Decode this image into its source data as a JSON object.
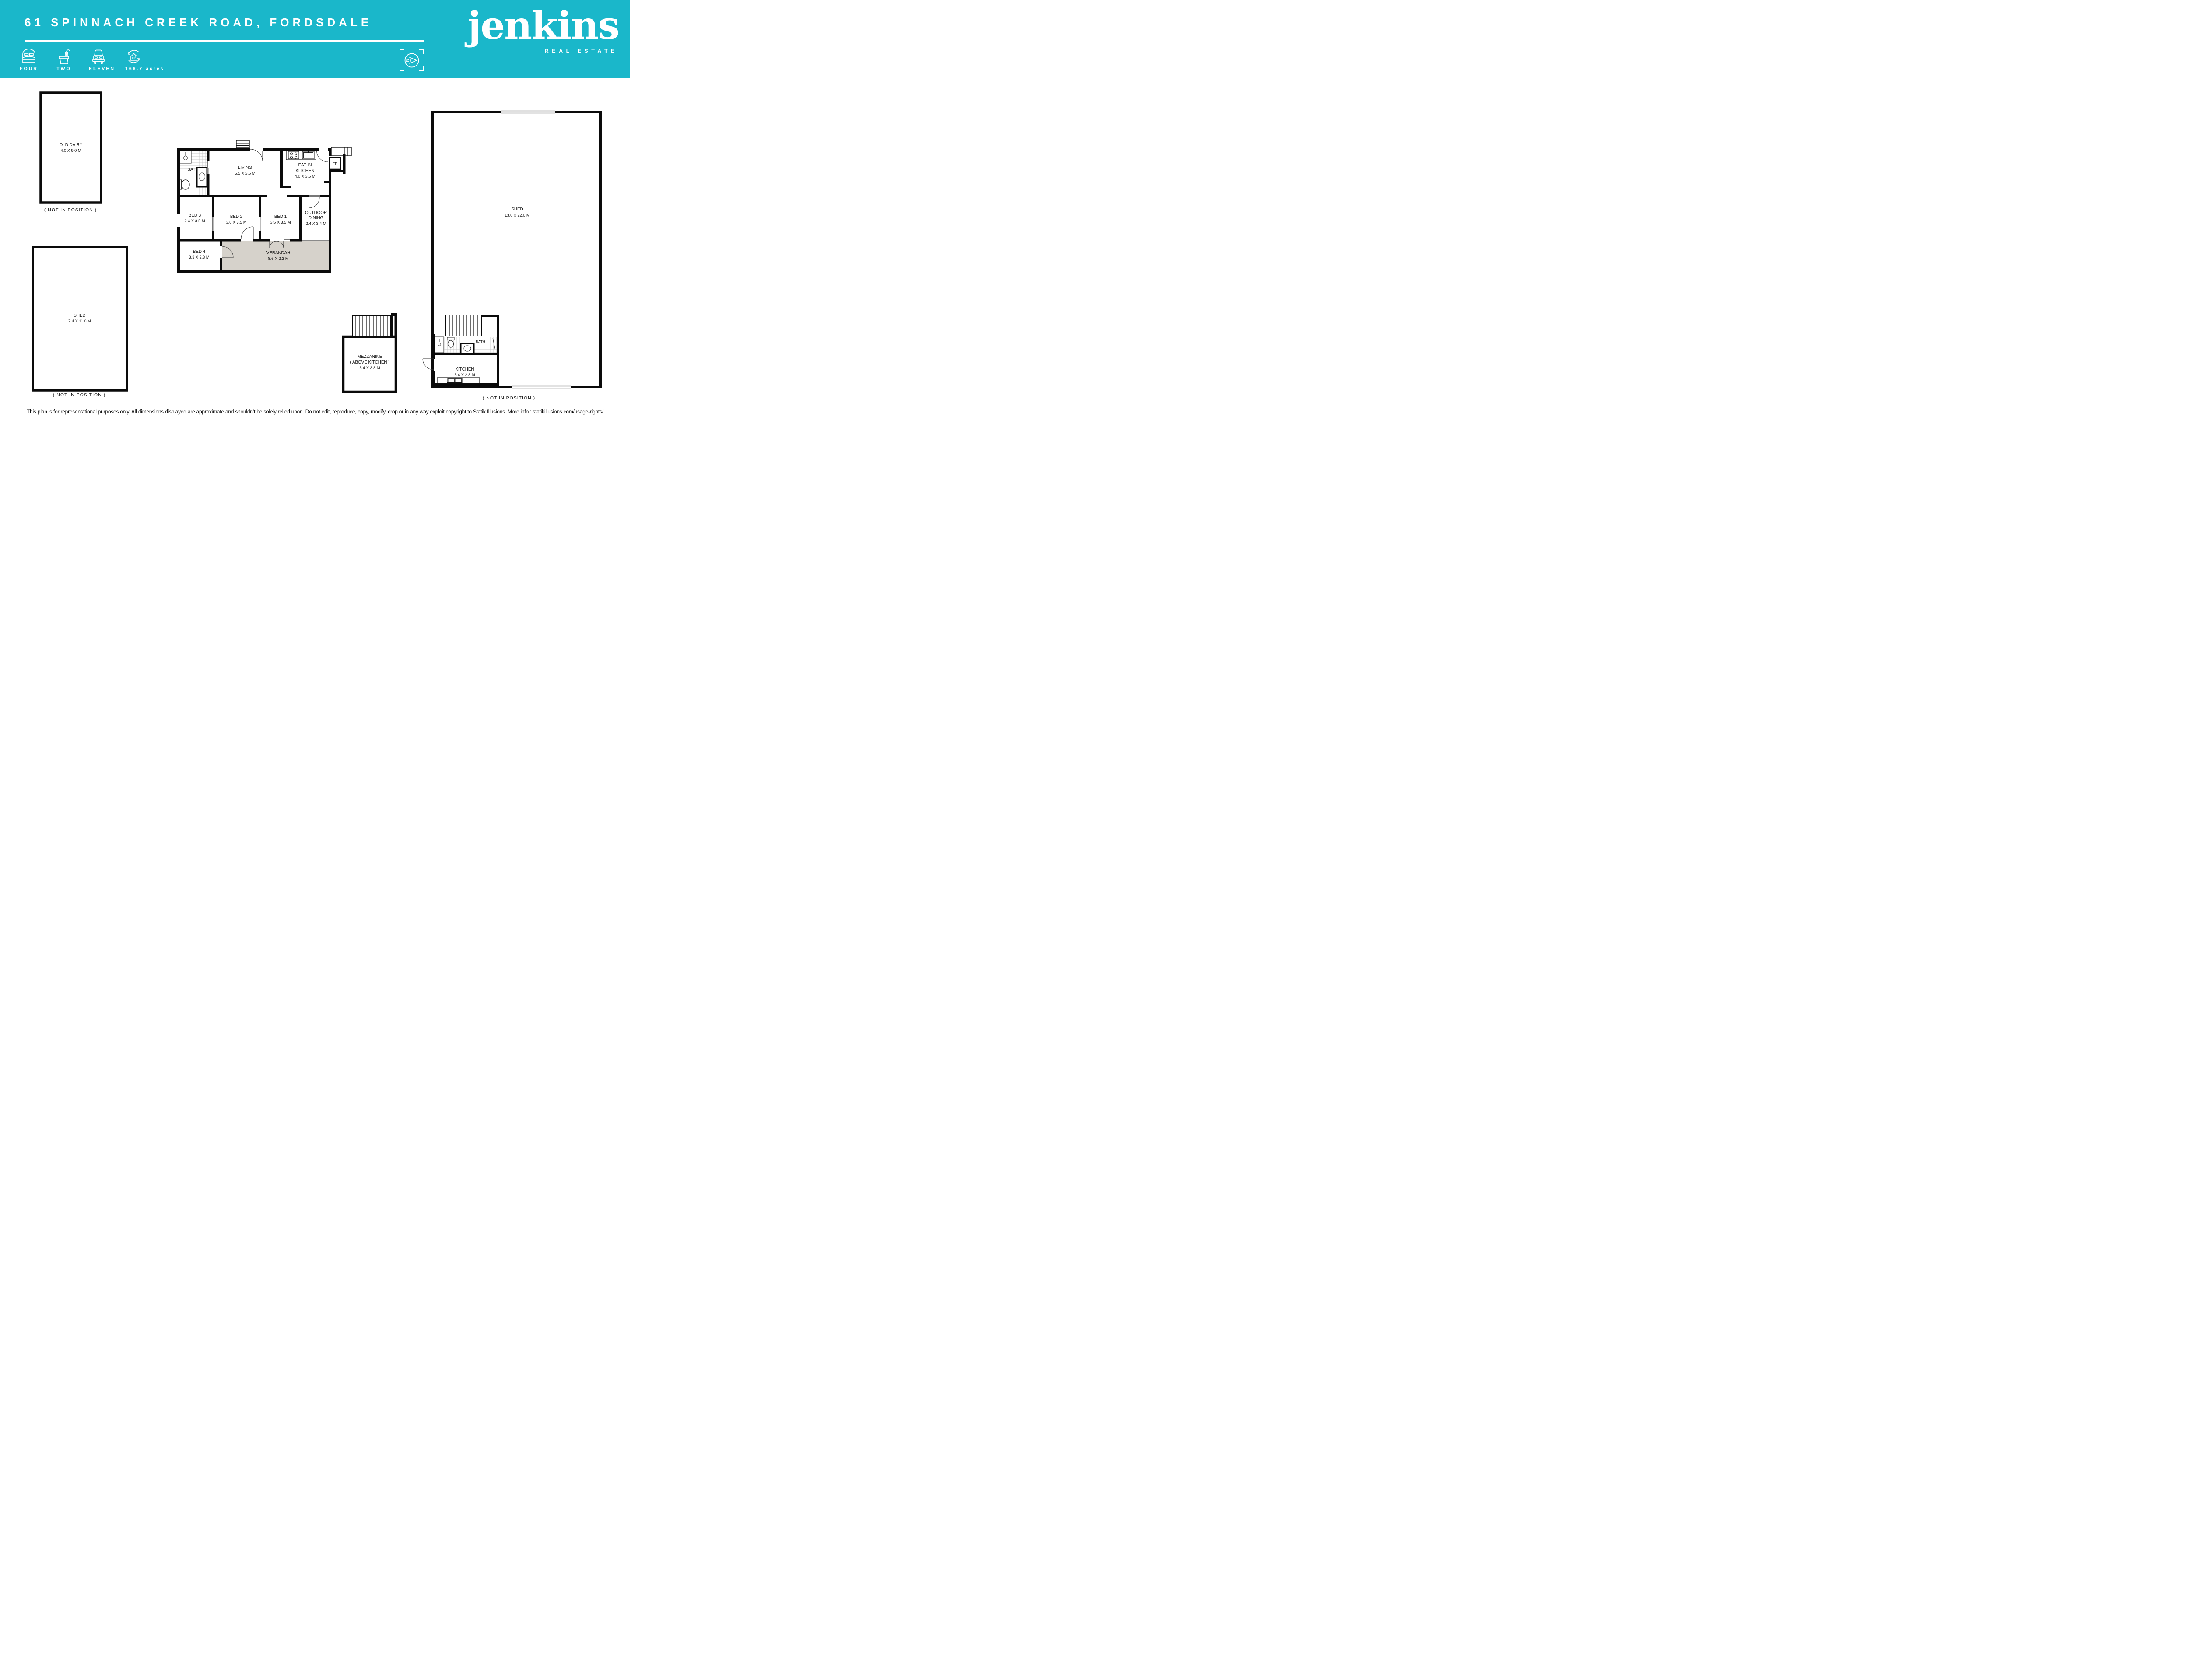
{
  "header": {
    "title": "61 SPINNACH CREEK ROAD, FORDSDALE",
    "stats": [
      {
        "icon": "bed-icon",
        "label": "FOUR"
      },
      {
        "icon": "bath-icon",
        "label": "TWO"
      },
      {
        "icon": "car-icon",
        "label": "ELEVEN"
      },
      {
        "icon": "area-icon",
        "label": "166.7 acres"
      }
    ],
    "compass_letter": "N",
    "brand": {
      "name": "jenkins",
      "tagline": "REAL ESTATE"
    }
  },
  "colors": {
    "teal": "#1ab7ca",
    "wall": "#0a0a0a",
    "verandah": "#d6d2cb",
    "tile_line": "#b9b9b9"
  },
  "plans": {
    "old_dairy": {
      "name": "OLD DAIRY",
      "dims": "4.0 X 9.0 M",
      "caption": "( NOT IN POSITION )"
    },
    "shed_small": {
      "name": "SHED",
      "dims": "7.4 X 11.0 M",
      "caption": "( NOT IN POSITION )"
    },
    "shed_large": {
      "name": "SHED",
      "dims": "13.0 X 22.0 M",
      "caption": "( NOT IN POSITION )"
    },
    "house": {
      "bath": {
        "name": "BATH"
      },
      "living": {
        "name": "LIVING",
        "dims": "5.5 X 3.6 M"
      },
      "eat_in": {
        "line1": "EAT-IN",
        "line2": "KITCHEN",
        "dims": "4.0 X 3.6 M"
      },
      "fp": {
        "name": "FP"
      },
      "bed1": {
        "name": "BED 1",
        "dims": "3.5 X 3.5 M"
      },
      "bed2": {
        "name": "BED 2",
        "dims": "3.6 X 3.5 M"
      },
      "bed3": {
        "name": "BED 3",
        "dims": "2.4 X 3.5 M"
      },
      "bed4": {
        "name": "BED 4",
        "dims": "3.3 X 2.3 M"
      },
      "outdoor": {
        "line1": "OUTDOOR",
        "line2": "DINING",
        "dims": "2.4 X 3.4 M"
      },
      "verandah": {
        "name": "VERANDAH",
        "dims": "8.6 X 2.3 M"
      }
    },
    "mezzanine": {
      "line1": "MEZZANINE",
      "line2": "( ABOVE KITCHEN )",
      "dims": "5.4 X 3.8 M"
    },
    "shed_kitchen": {
      "bath": "BATH",
      "name": "KITCHEN",
      "dims": "5.4 X 2.8 M"
    }
  },
  "footer": {
    "disclaimer": "This plan is for representational purposes only. All dimensions displayed are approximate and shouldn’t be solely relied upon. Do not edit, reproduce, copy, modify, crop or in any way exploit copyright to Statik Illusions. More info : statikillusions.com/usage-rights/"
  }
}
